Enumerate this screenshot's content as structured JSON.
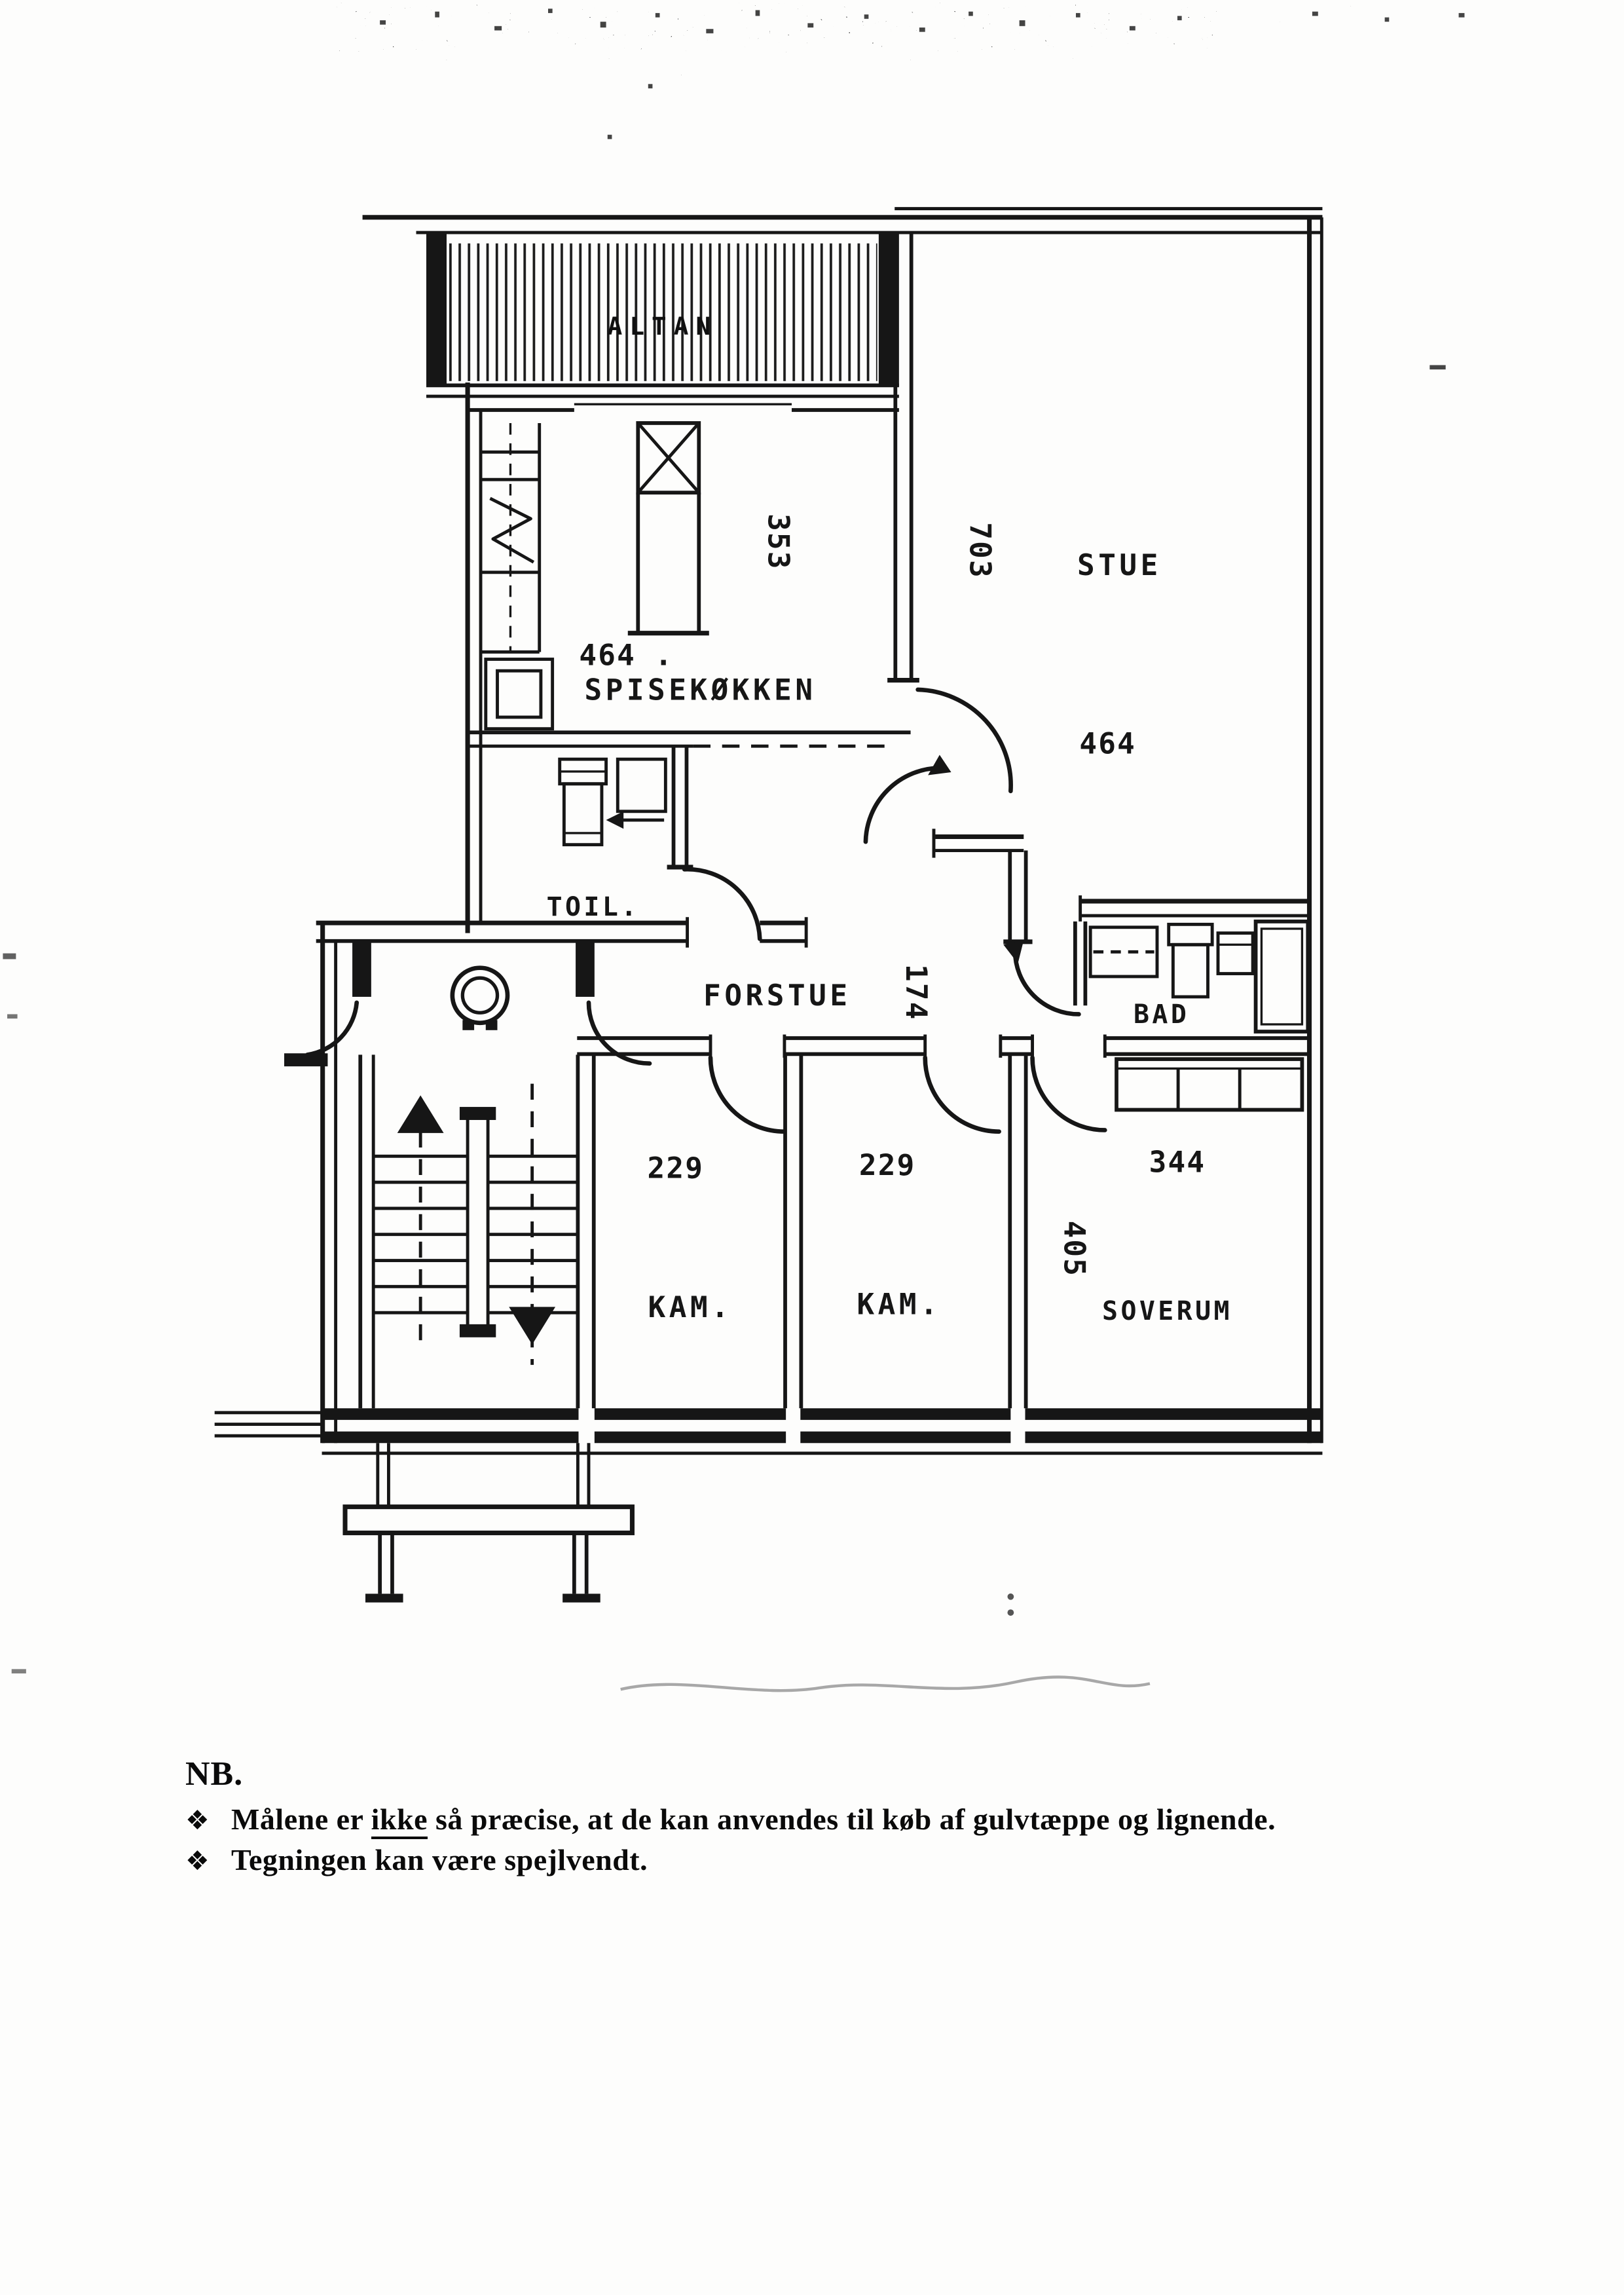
{
  "colors": {
    "ink": "#161616",
    "paper": "#fdfdfc"
  },
  "floorplan": {
    "balcony": {
      "label": "ALTAN"
    },
    "kitchen": {
      "dim_width": "464 .",
      "label": "SPISEKØKKEN",
      "dim_depth": "353"
    },
    "living": {
      "dim_depth": "703",
      "label": "STUE",
      "dim_width": "464"
    },
    "toilet": {
      "label": "TOIL."
    },
    "hall": {
      "label": "FORSTUE",
      "dim_width": "174"
    },
    "bath": {
      "label": "BAD"
    },
    "chamber1": {
      "dim_width": "229",
      "label": "KAM."
    },
    "chamber2": {
      "dim_width": "229",
      "label": "KAM."
    },
    "bedroom": {
      "dim_width": "344",
      "dim_depth": "405",
      "label": "SOVERUM"
    }
  },
  "note": {
    "heading": "NB.",
    "bullet_glyph": "❖",
    "item1_pre": "Målene er ",
    "item1_underlined": "ikke",
    "item1_post": " så præcise, at de kan anvendes til køb af gulvtæppe og lignende.",
    "item2": "Tegningen kan være spejlvendt."
  }
}
